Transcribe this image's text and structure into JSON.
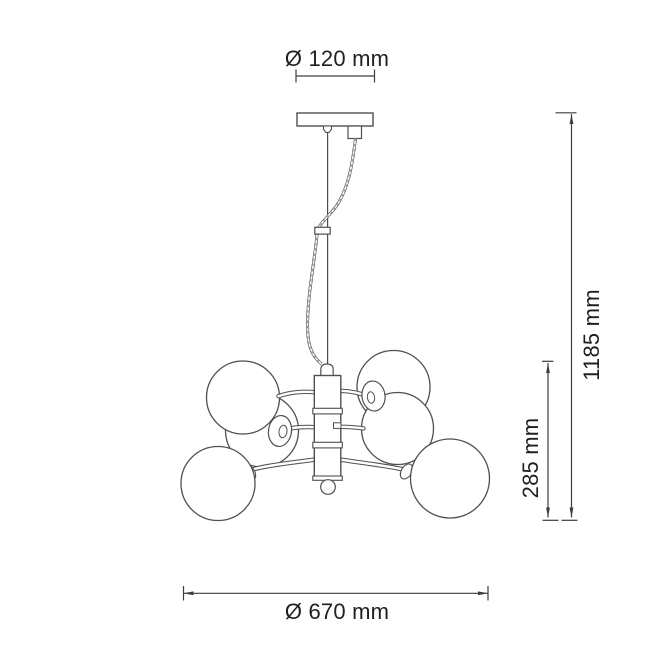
{
  "drawing": {
    "kind": "technical dimension line drawing",
    "subject": "pendant chandelier with six glass globes on a central column",
    "globe_count": 6
  },
  "dimensions": {
    "canopy_diameter": "Ø 120 mm",
    "overall_height": "1185 mm",
    "body_height": "285 mm",
    "fixture_diameter": "Ø 670 mm"
  },
  "colors": {
    "background": "#ffffff",
    "fixture_line": "#4f4f4f",
    "dimension_line": "#3d3d3d",
    "text": "#1f1f1f"
  }
}
